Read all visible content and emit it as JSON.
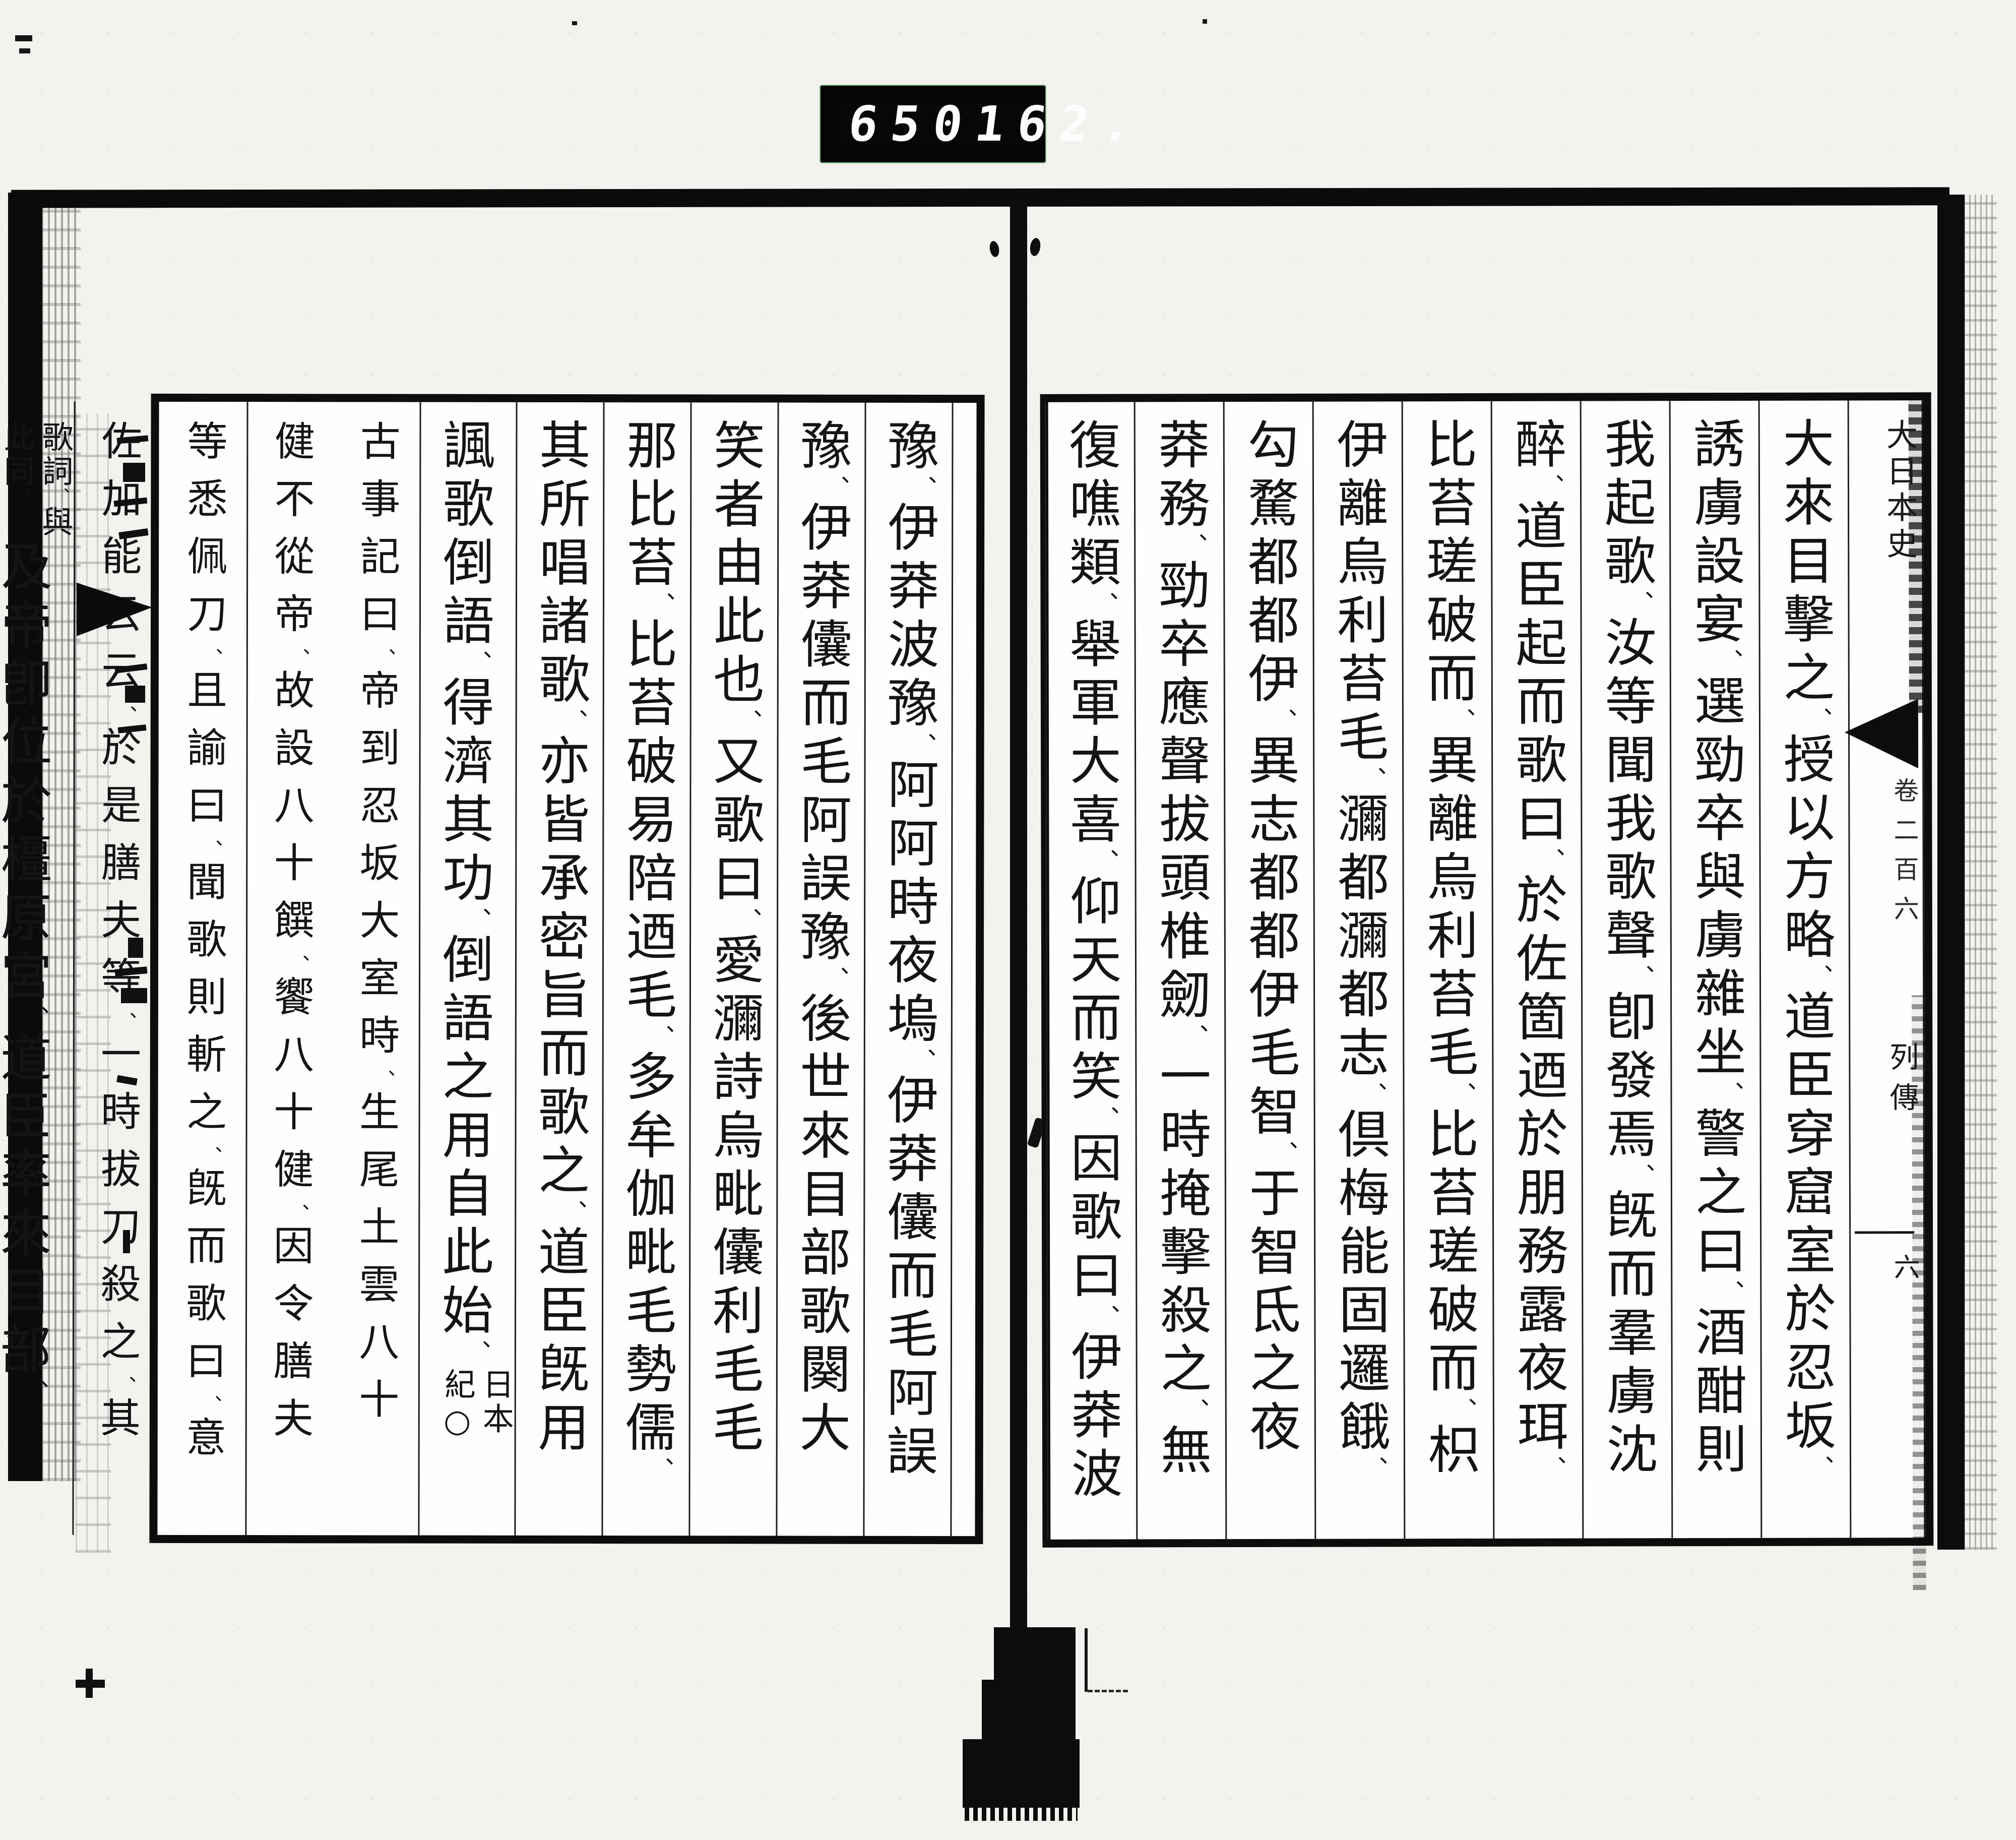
{
  "counter": {
    "reel": "650",
    "frame": "162."
  },
  "right_page": {
    "header": {
      "title": "大日本史",
      "volume": "卷二百六",
      "section": "列傳",
      "leaf": "六"
    },
    "columns": [
      {
        "segments": [
          {
            "t": "big",
            "text": "大來目擊之、授以方略、道臣穿窟室於忍坂、"
          }
        ]
      },
      {
        "segments": [
          {
            "t": "big",
            "text": "誘虜設宴、選勁卒與虜雜坐、警之曰、酒酣則"
          }
        ]
      },
      {
        "segments": [
          {
            "t": "big",
            "text": "我起歌、汝等聞我歌聲、卽發焉、旣而羣虜沈"
          }
        ]
      },
      {
        "segments": [
          {
            "t": "big",
            "text": "醉、道臣起而歌曰、於佐箇迺於朋務露夜珥、"
          }
        ]
      },
      {
        "segments": [
          {
            "t": "big",
            "text": "比苔瑳破而、異離烏利苔毛、比苔瑳破而、枳"
          }
        ]
      },
      {
        "segments": [
          {
            "t": "big",
            "text": "伊離烏利苔毛、瀰都瀰都志、倶梅能固邏餓、"
          }
        ]
      },
      {
        "segments": [
          {
            "t": "big",
            "text": "勾騖都都伊、異志都都伊毛智、于智氐之夜"
          }
        ]
      },
      {
        "segments": [
          {
            "t": "big",
            "text": "莽務、勁卒應聲拔頭椎劒、一時掩擊殺之、無"
          }
        ]
      },
      {
        "segments": [
          {
            "t": "big",
            "text": "復噍類、舉軍大喜、仰天而笑、因歌曰、伊莽波"
          }
        ]
      }
    ]
  },
  "left_page": {
    "columns": [
      {
        "segments": [
          {
            "t": "big",
            "text": "豫、伊莽波豫、阿阿時夜塢、伊莽儾而毛阿誤"
          }
        ]
      },
      {
        "segments": [
          {
            "t": "big",
            "text": "豫、伊莽儾而毛阿誤豫、後世來目部歌闋大"
          }
        ]
      },
      {
        "segments": [
          {
            "t": "big",
            "text": "笑者由此也、又歌曰、愛瀰詩烏毗儾利毛毛"
          }
        ]
      },
      {
        "segments": [
          {
            "t": "big",
            "text": "那比苔、比苔破易陪迺毛、多牟伽毗毛勢儒、"
          }
        ]
      },
      {
        "segments": [
          {
            "t": "big",
            "text": "其所唱諸歌、亦皆承密旨而歌之、道臣旣用"
          }
        ]
      },
      {
        "segments": [
          {
            "t": "big",
            "text": "諷歌倒語、得濟其功、倒語之用自此始、"
          },
          {
            "t": "note",
            "lines": [
              "日本",
              "紀○"
            ]
          }
        ]
      },
      {
        "segments": [
          {
            "t": "small2",
            "lines": [
              "古事記曰、帝到忍坂大室時、生尾土雲八十",
              "健不從帝、故設八十饌、饗八十健、因令膳夫"
            ]
          }
        ]
      },
      {
        "segments": [
          {
            "t": "small2",
            "lines": [
              "等悉佩刀、且諭曰、聞歌則斬之、旣而歌曰、意",
              "佐加能云云、於是膳夫等、一時拔刀殺之、其"
            ]
          }
        ]
      },
      {
        "segments": [
          {
            "t": "note",
            "lines": [
              "歌詞、與",
              "此同、"
            ]
          },
          {
            "t": "big",
            "text": "及帝卽位於橿原宮、道臣率來目部、"
          }
        ]
      }
    ]
  }
}
